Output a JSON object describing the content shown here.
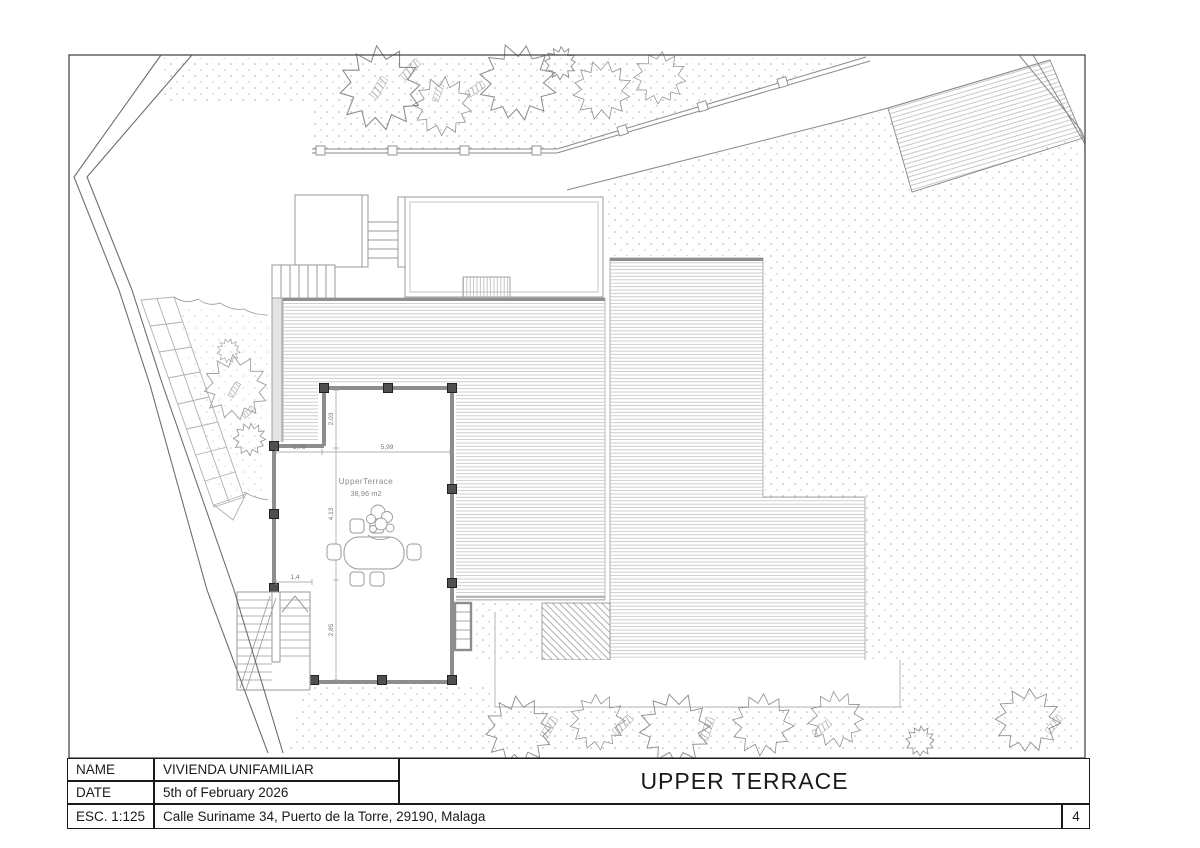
{
  "title_block": {
    "name_label": "NAME",
    "name_value": "VIVIENDA UNIFAMILIAR",
    "date_label": "DATE",
    "date_value": "5th of February 2026",
    "scale_label": "ESC. 1:125",
    "address": "Calle Suriname 34, Puerto de la Torre, 29190, Malaga",
    "sheet_title": "UPPER TERRACE",
    "page_number": "4"
  },
  "plan": {
    "room_label": "UpperTerrace",
    "room_area": "38,96 m2",
    "dimensions": {
      "left_width": "1,76",
      "top_width": "5,99",
      "upper_height": "2,03",
      "middle_height": "4,13",
      "lower_width": "1,4",
      "lower_height": "2,85"
    }
  },
  "drawing_palette": {
    "line": "#555555",
    "wall": "#8d8d8d",
    "column": "#4f4f4f",
    "hatch": "#c3c3c3",
    "stipple": "#ababab",
    "vegetation": "#8a8a8a"
  }
}
